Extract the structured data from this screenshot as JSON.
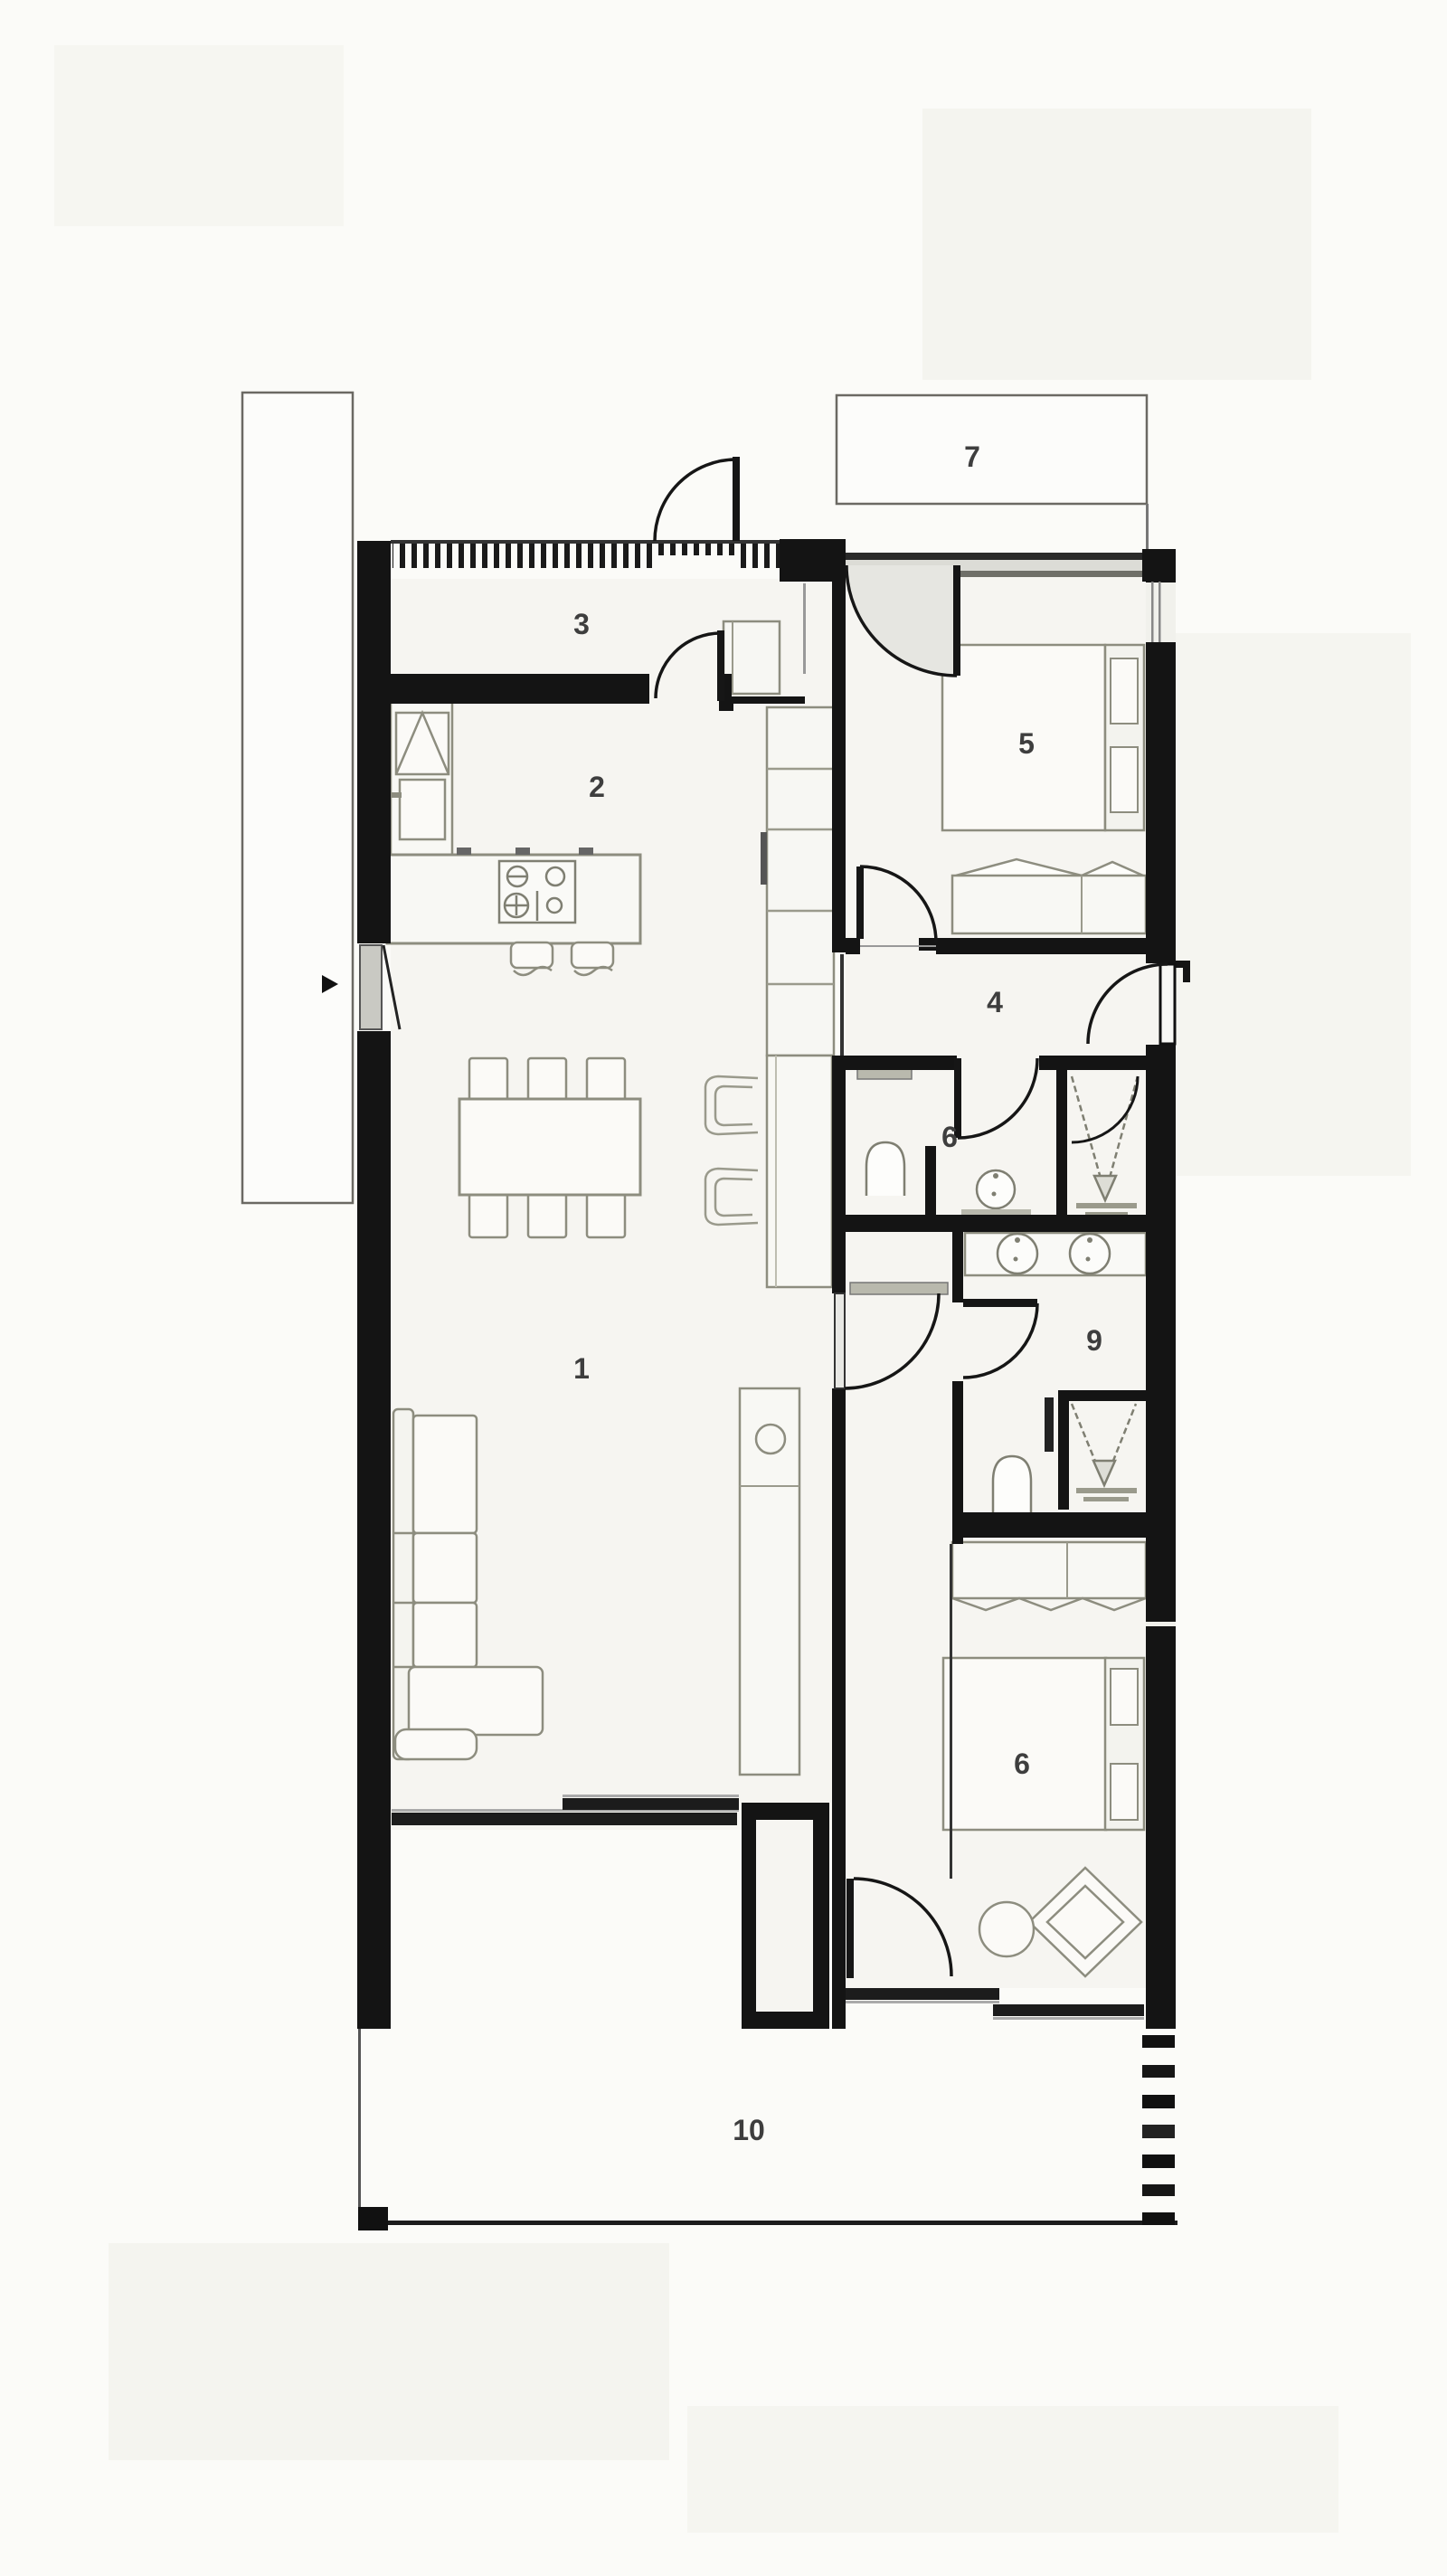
{
  "page": {
    "background": "#fbfbf8"
  },
  "plan": {
    "wall_color": "#141414",
    "floor_color": "#f6f5f1",
    "furniture_line_color": "#8d8d7f",
    "label_color": "#3e3e3e",
    "window_gray": "#c9c9c3"
  },
  "rooms": [
    {
      "number": "1",
      "name": "living-room"
    },
    {
      "number": "2",
      "name": "kitchen"
    },
    {
      "number": "3",
      "name": "entry-hall"
    },
    {
      "number": "4",
      "name": "hallway"
    },
    {
      "number": "5",
      "name": "bedroom-1"
    },
    {
      "number": "6",
      "name": "bathroom-1"
    },
    {
      "number": "7",
      "name": "terrace-upper"
    },
    {
      "number": "6",
      "name": "bedroom-2"
    },
    {
      "number": "9",
      "name": "bathroom-2"
    },
    {
      "number": "10",
      "name": "terrace-lower"
    }
  ],
  "fixtures": [
    "bed",
    "wardrobe",
    "sofa",
    "dining-table",
    "chair",
    "bar-stool",
    "kitchen-island",
    "cooktop",
    "sink",
    "toilet",
    "shower",
    "vanity",
    "desk",
    "pouf",
    "stool",
    "sliding-door",
    "hinged-door"
  ]
}
